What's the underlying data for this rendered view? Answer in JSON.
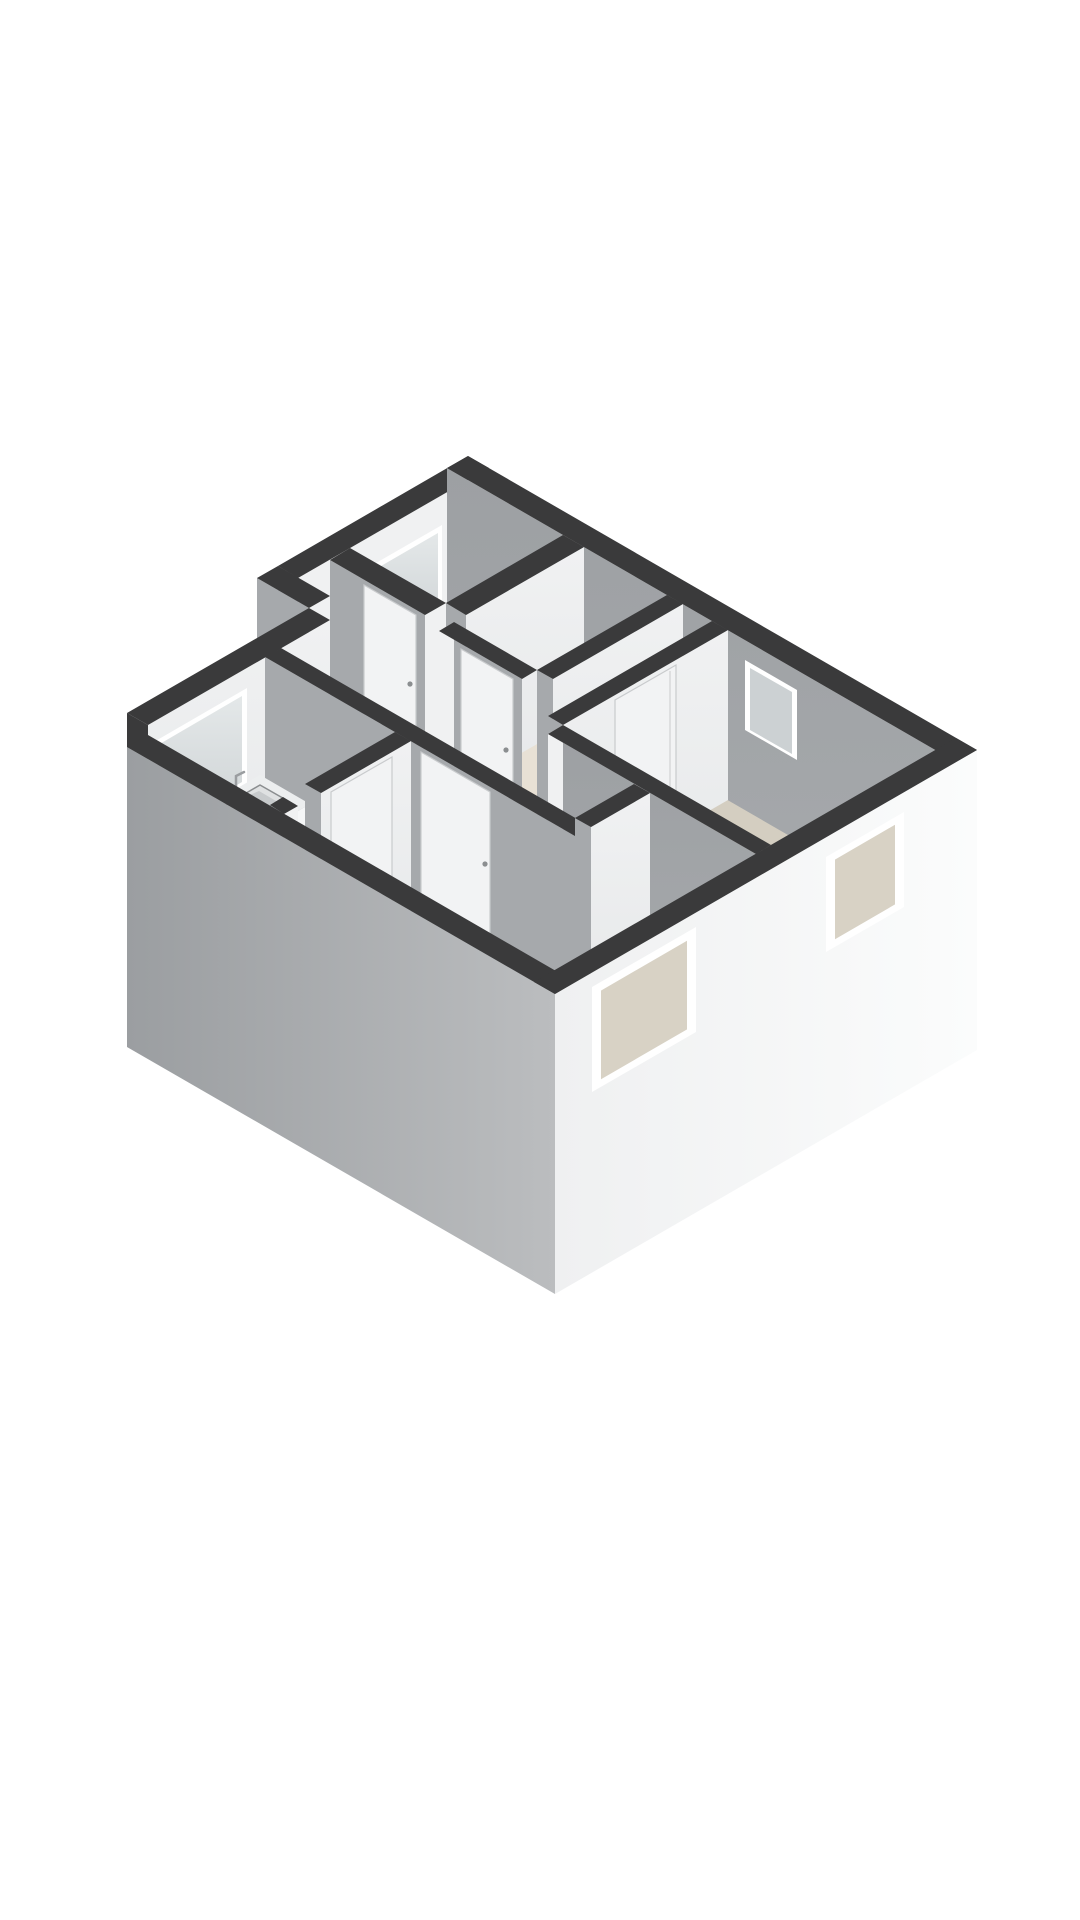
{
  "scene": {
    "kind": "3d-floorplan-render",
    "rooms": [
      "living-room",
      "bedroom",
      "kitchen",
      "hallway",
      "bathroom",
      "toilet-room"
    ],
    "fixtures": [
      "kitchen-counter",
      "stove",
      "kitchen-sink",
      "kitchen-faucet",
      "bathroom-sink",
      "towel-hook",
      "toilet",
      "interior-doors",
      "windows"
    ]
  },
  "colors": {
    "background": "#ffffff",
    "wallTop": "#3a3a3b",
    "wallLight": "#f0f1f2",
    "wallLightDim": "#e7e9ea",
    "wallGray": "#a6a9ac",
    "wallGrayDim": "#9da0a3",
    "extGray": "#9b9ea1",
    "extGrayLight": "#bbbdbf",
    "extWhite": "#fbfcfc",
    "extWhiteDim": "#eff0f1",
    "floor": "#d4cec1",
    "floorWet": "#e8e1d5",
    "glass": "#ccd1d3",
    "glassLight": "#e4e8e9",
    "sill": "#e9ebec",
    "frameWhite": "#ffffff",
    "windowBeige": "#d8d2c5",
    "counterTop": "#eceeef",
    "counterFront": "#f5f6f7",
    "counterSide": "#dde0e1",
    "counterSeam": "#d8dadb",
    "stove": "#2e2f30",
    "burner": "#6f7274",
    "burnerDot": "#1d1e1f",
    "steel": "#dfe1e2",
    "steelDark": "#c7cacc",
    "steelStroke": "#8a8d8f",
    "fixture": "#f6f7f7",
    "fixtureShade": "#e9ebeb",
    "fixtureSide": "#dfe1e2",
    "doorWhite": "#f2f3f4",
    "doorSeam": "#c9cbcd",
    "handle": "#8b8e90",
    "faucet": "#9a9da0"
  }
}
